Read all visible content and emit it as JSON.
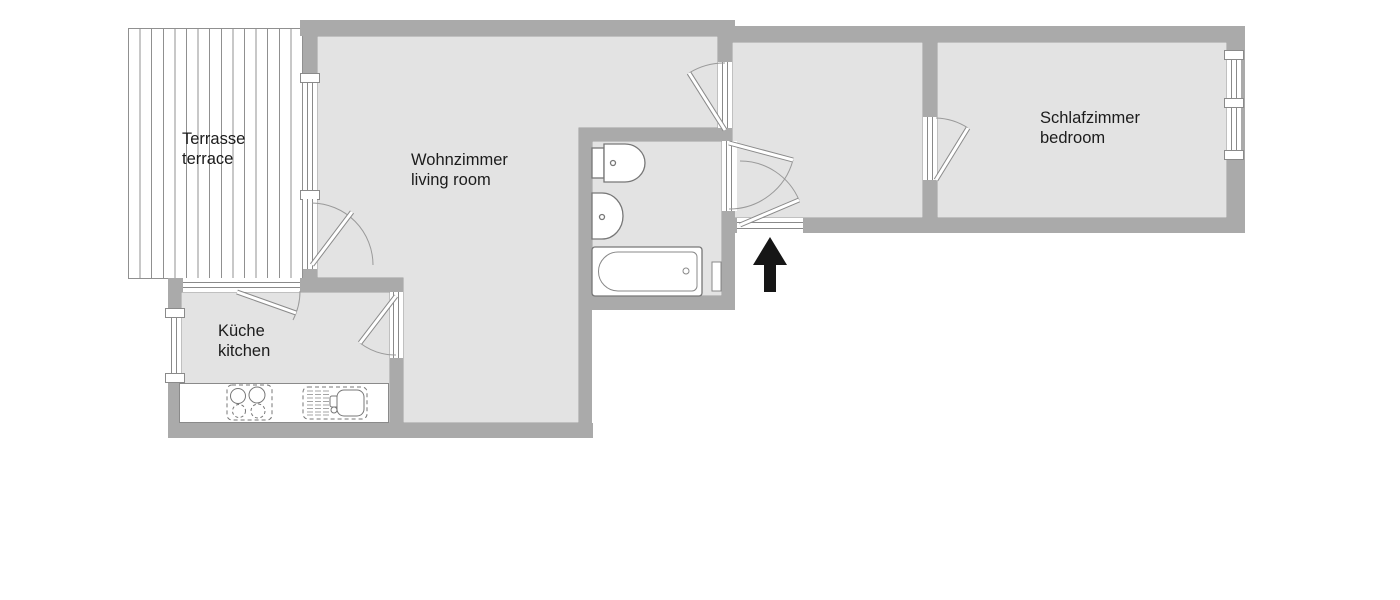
{
  "title": "apartment floor plan",
  "rooms": {
    "terrace": {
      "name_de": "Terrasse",
      "name_en": "terrace"
    },
    "living_room": {
      "name_de": "Wohnzimmer",
      "name_en": "living room"
    },
    "kitchen": {
      "name_de": "Küche",
      "name_en": "kitchen"
    },
    "bedroom": {
      "name_de": "Schlafzimmer",
      "name_en": "bedroom"
    }
  },
  "elements": [
    "terrace-decking",
    "bathtub",
    "toilet",
    "bathroom-sink",
    "radiator",
    "kitchen-counter",
    "stove",
    "kitchen-sink",
    "entrance-arrow",
    "door-swing-arcs",
    "windows"
  ],
  "colors": {
    "wall": "#aaaaaa",
    "floor": "#e3e3e3",
    "line": "#8a8a8a",
    "fixture_outline": "#777777",
    "text": "#1c1c1c",
    "arrow": "#161616",
    "background": "#ffffff",
    "terrace_line": "#909090"
  }
}
